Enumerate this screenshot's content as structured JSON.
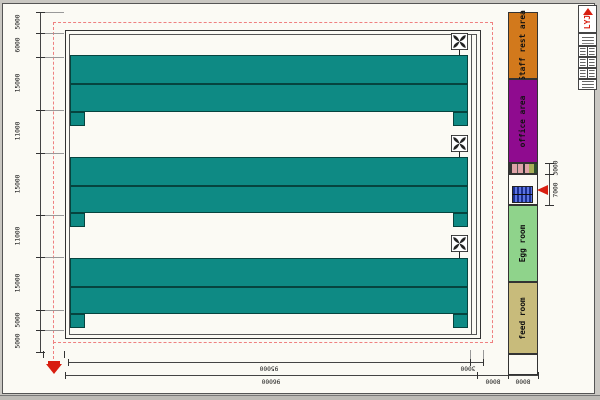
{
  "drawing": {
    "type": "poultry-house-layout-plan",
    "rooms": {
      "staff": {
        "label": "Staff rest area",
        "color": "#d2791c"
      },
      "office": {
        "label": "office area",
        "color": "#8f0b8f"
      },
      "egg": {
        "label": "Egg room",
        "color": "#8fd38b"
      },
      "feed": {
        "label": "feed room",
        "color": "#c8bb7b"
      }
    },
    "dims": {
      "left": [
        "5000",
        "6000",
        "15000",
        "11000",
        "15000",
        "11000",
        "15000",
        "5000",
        "5000"
      ],
      "bottom_row1": [
        "95000",
        "3000"
      ],
      "bottom_row2": [
        "96000",
        "8000",
        "8000"
      ],
      "annex": [
        "3000",
        "7000"
      ]
    },
    "colors": {
      "cage_rows": "#0e8a84",
      "boundary_dash": "#ef8080",
      "arrow": "#d81e10",
      "stairs": "#1b2f8f"
    },
    "title_block": {
      "logo": "LYJ"
    }
  }
}
